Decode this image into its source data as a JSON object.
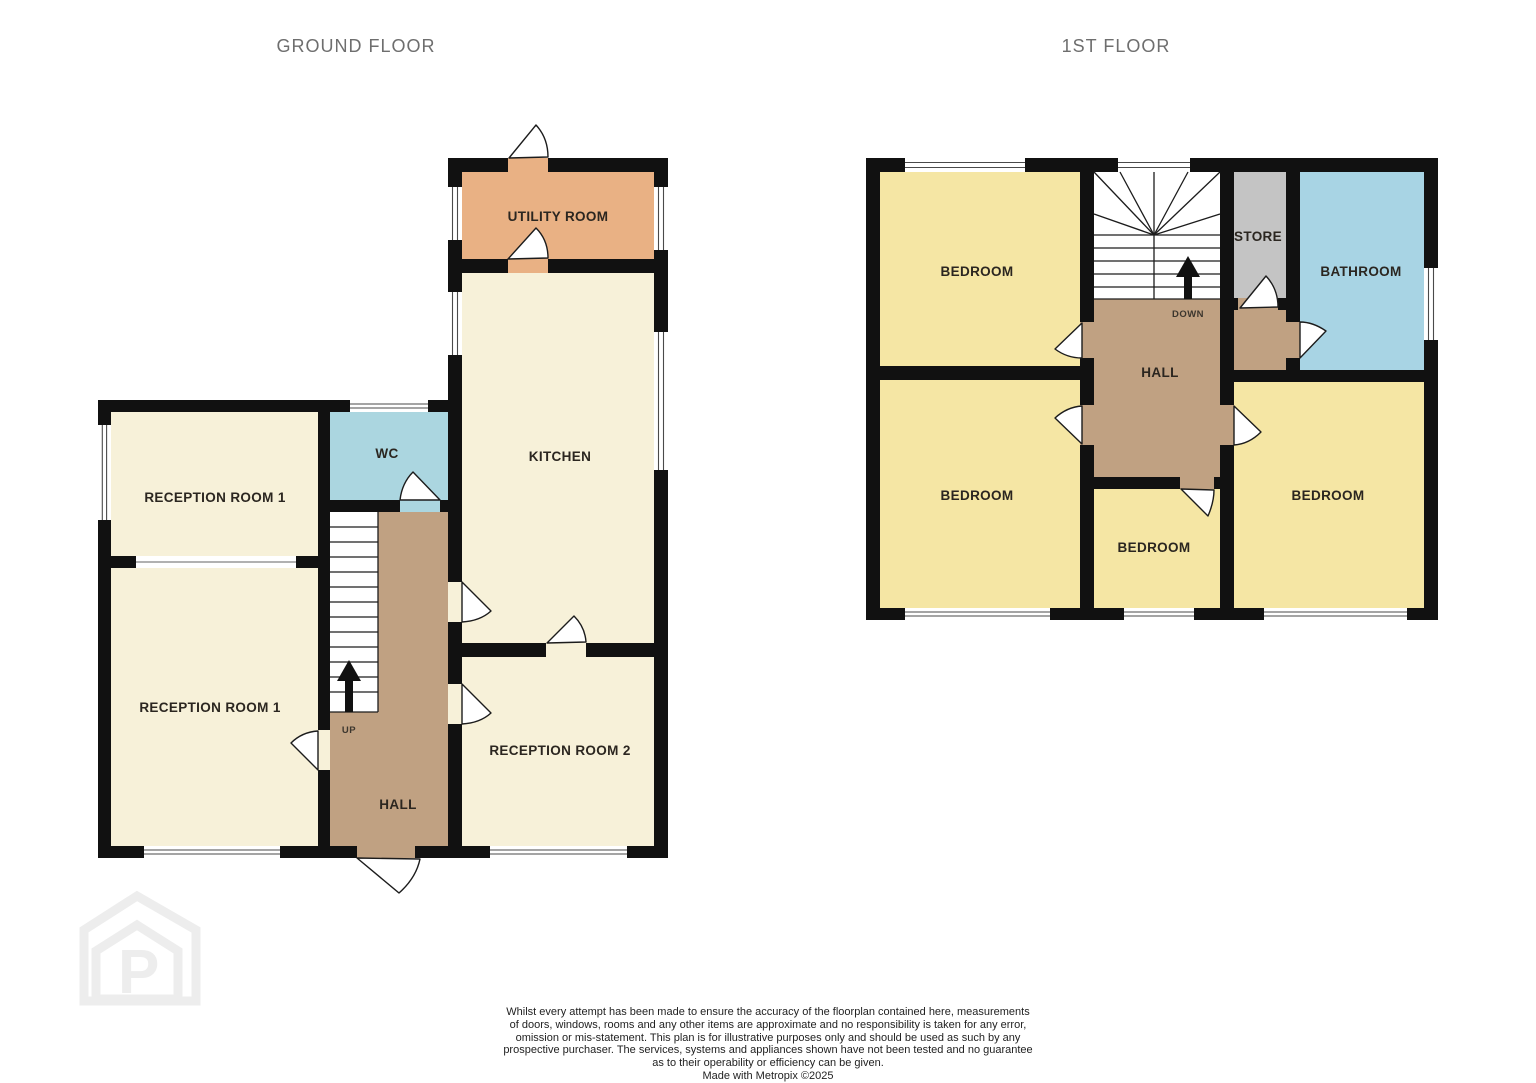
{
  "titles": {
    "ground": "GROUND FLOOR",
    "first": "1ST FLOOR"
  },
  "colors": {
    "wall": "#111111",
    "cream": "#f7f1d9",
    "bedroom": "#f5e6a4",
    "utility": "#e9b184",
    "wc": "#abd6e0",
    "bathroom": "#a8d4e4",
    "hall": "#c0a182",
    "store": "#c4c4c4",
    "stairs": "#ffffff"
  },
  "ground_floor": {
    "rooms": [
      {
        "name": "utility-room",
        "label": "UTILITY ROOM"
      },
      {
        "name": "kitchen",
        "label": "KITCHEN"
      },
      {
        "name": "wc",
        "label": "WC"
      },
      {
        "name": "reception-room-1-front",
        "label": "RECEPTION ROOM 1"
      },
      {
        "name": "reception-room-1-back",
        "label": "RECEPTION ROOM 1"
      },
      {
        "name": "reception-room-2",
        "label": "RECEPTION ROOM 2"
      },
      {
        "name": "hall",
        "label": "HALL"
      }
    ],
    "stair_label": "UP"
  },
  "first_floor": {
    "rooms": [
      {
        "name": "bedroom-top-left",
        "label": "BEDROOM"
      },
      {
        "name": "store",
        "label": "STORE"
      },
      {
        "name": "bathroom",
        "label": "BATHROOM"
      },
      {
        "name": "hall",
        "label": "HALL"
      },
      {
        "name": "bedroom-bottom-left",
        "label": "BEDROOM"
      },
      {
        "name": "bedroom-middle",
        "label": "BEDROOM"
      },
      {
        "name": "bedroom-right",
        "label": "BEDROOM"
      }
    ],
    "stair_label": "DOWN"
  },
  "footer": {
    "lines": [
      "Whilst every attempt has been made to ensure the accuracy of the floorplan contained here, measurements",
      "of doors, windows, rooms and any other items are approximate and no responsibility is taken for any error,",
      "omission or mis-statement. This plan is for illustrative purposes only and should be used as such by any",
      "prospective purchaser. The services, systems and appliances shown have not been tested and no guarantee",
      "as to their operability or efficiency can be given."
    ],
    "credit": "Made with Metropix ©2025"
  },
  "watermark": {
    "letter": "P"
  }
}
